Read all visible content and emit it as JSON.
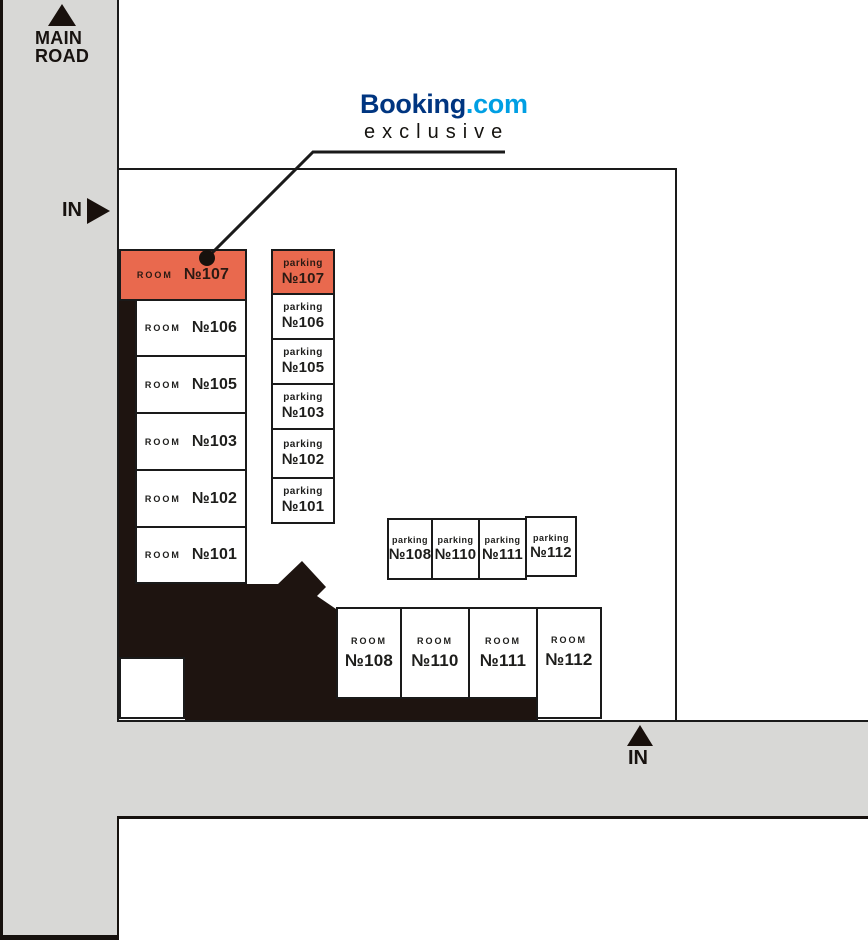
{
  "roads": {
    "main_road_line1": "MAIN",
    "main_road_line2": "ROAD",
    "entrance_left": "IN",
    "entrance_bottom": "IN"
  },
  "branding": {
    "brand_primary": "Booking",
    "brand_suffix": ".com",
    "brand_tagline": "exclusive"
  },
  "left_rooms": [
    {
      "label": "ROOM",
      "number": "№107",
      "highlight": true
    },
    {
      "label": "ROOM",
      "number": "№106",
      "highlight": false
    },
    {
      "label": "ROOM",
      "number": "№105",
      "highlight": false
    },
    {
      "label": "ROOM",
      "number": "№103",
      "highlight": false
    },
    {
      "label": "ROOM",
      "number": "№102",
      "highlight": false
    },
    {
      "label": "ROOM",
      "number": "№101",
      "highlight": false
    }
  ],
  "parking_column": [
    {
      "label": "parking",
      "number": "№107",
      "highlight": true
    },
    {
      "label": "parking",
      "number": "№106",
      "highlight": false
    },
    {
      "label": "parking",
      "number": "№105",
      "highlight": false
    },
    {
      "label": "parking",
      "number": "№103",
      "highlight": false
    },
    {
      "label": "parking",
      "number": "№102",
      "highlight": false
    },
    {
      "label": "parking",
      "number": "№101",
      "highlight": false
    }
  ],
  "parking_row": [
    {
      "label": "parking",
      "number": "№108"
    },
    {
      "label": "parking",
      "number": "№110"
    },
    {
      "label": "parking",
      "number": "№111"
    },
    {
      "label": "parking",
      "number": "№112"
    }
  ],
  "bottom_rooms": [
    {
      "label": "ROOM",
      "number": "№108"
    },
    {
      "label": "ROOM",
      "number": "№110"
    },
    {
      "label": "ROOM",
      "number": "№111"
    },
    {
      "label": "ROOM",
      "number": "№112"
    }
  ],
  "colors": {
    "highlight_orange": "#E9694E",
    "road_gray": "#D8D8D6",
    "building_black": "#1E1410",
    "brand_navy": "#003580",
    "brand_blue": "#009FE3",
    "line_black": "#1A1A1A"
  }
}
